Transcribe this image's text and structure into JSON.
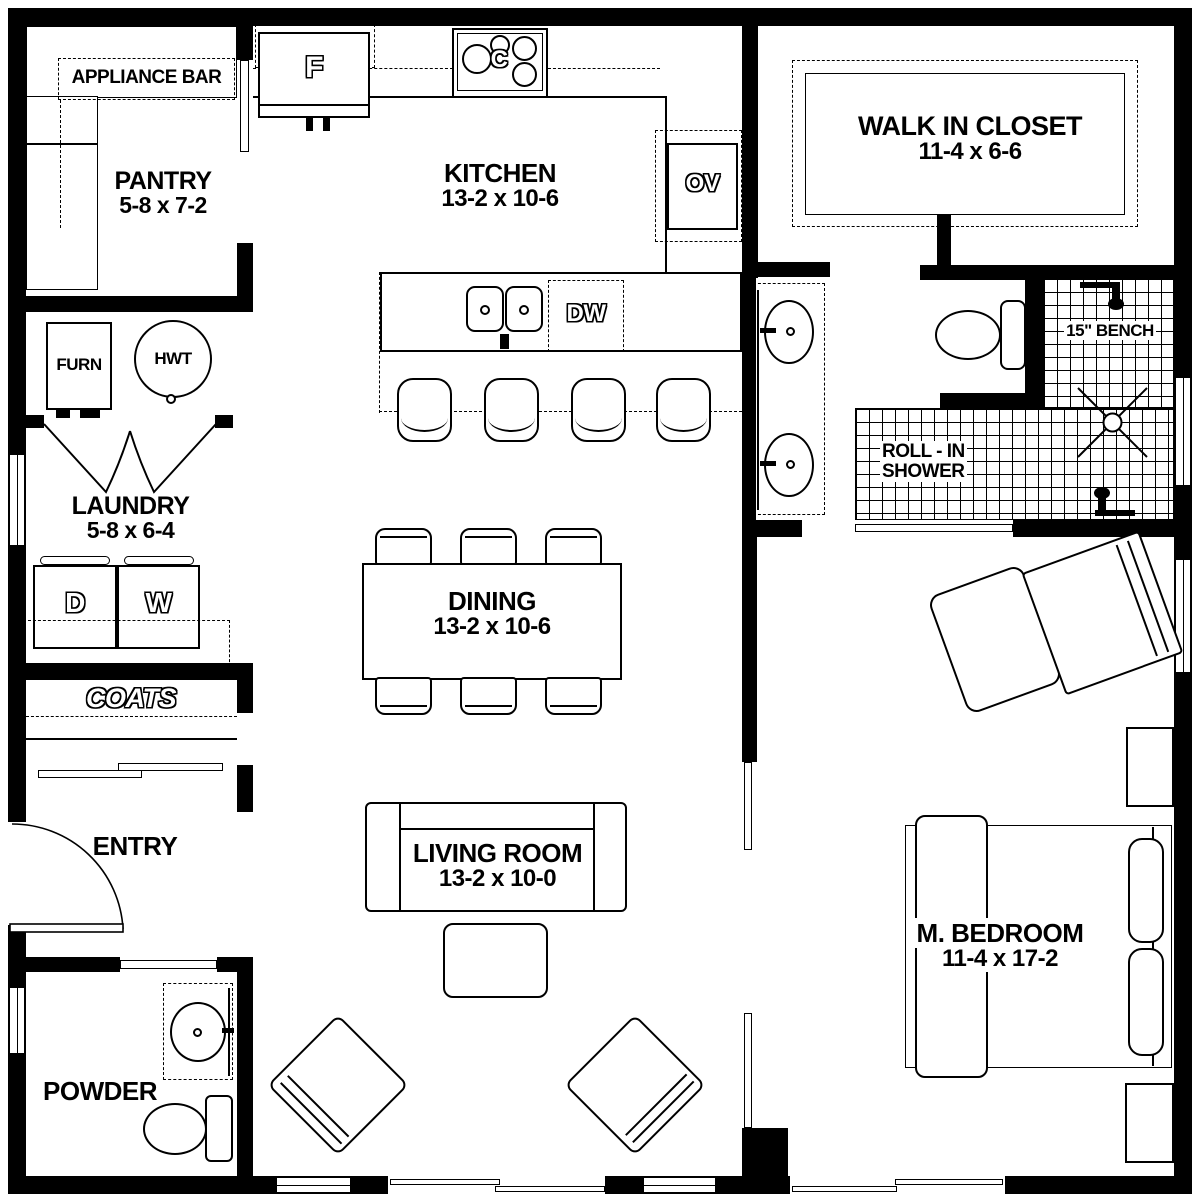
{
  "title": "Floor plan",
  "colors": {
    "wall": "#000000",
    "background": "#ffffff"
  },
  "rooms": {
    "pantry": {
      "name": "PANTRY",
      "dims": "5-8 x 7-2"
    },
    "kitchen": {
      "name": "KITCHEN",
      "dims": "13-2 x 10-6"
    },
    "walk_in_closet": {
      "name": "WALK IN CLOSET",
      "dims": "11-4 x 6-6"
    },
    "laundry": {
      "name": "LAUNDRY",
      "dims": "5-8 x 6-4"
    },
    "dining": {
      "name": "DINING",
      "dims": "13-2 x 10-6"
    },
    "living_room": {
      "name": "LIVING ROOM",
      "dims": "13-2 x 10-0"
    },
    "entry": {
      "name": "ENTRY"
    },
    "powder": {
      "name": "POWDER"
    },
    "master_bedroom": {
      "name": "M. BEDROOM",
      "dims": "11-4 x 17-2"
    }
  },
  "features": {
    "appliance_bar": "APPLIANCE BAR",
    "coats": "COATS",
    "bench": "15\" BENCH",
    "shower_line1": "ROLL - IN",
    "shower_line2": "SHOWER"
  },
  "appliances": {
    "fridge": "F",
    "cooktop": "C",
    "wall_oven": "OV",
    "dishwasher": "DW",
    "dryer": "D",
    "washer": "W",
    "furnace": "FURN",
    "water_heater": "HWT"
  }
}
